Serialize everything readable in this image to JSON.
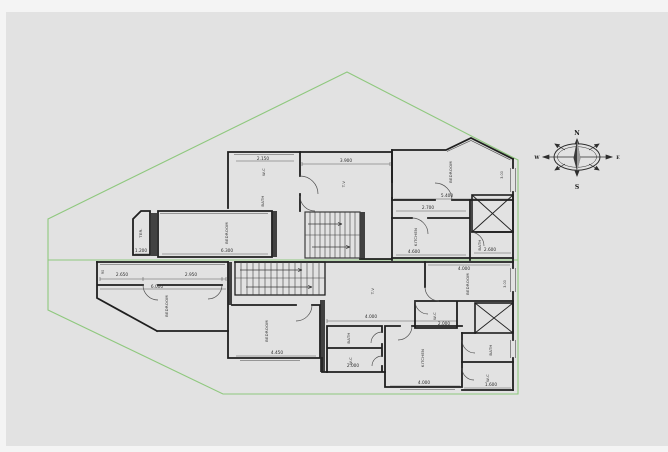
{
  "page": {
    "bg": "#f6f6f6",
    "canvas_bg": "#e2e2e2"
  },
  "colors": {
    "wall": "#1f1f1f",
    "thin": "#4a4a4a",
    "green": "#8fc87e",
    "text": "#2e2e2e"
  },
  "compass": {
    "north": "N",
    "south": "S",
    "east": "E",
    "west": "W"
  },
  "dims": {
    "wc_top": "2.150",
    "hall_top": "3.900",
    "bed1": "5.400",
    "corridor": "2.700",
    "kitchen1": "4.600",
    "bath1": "2.600",
    "balcony": "1.200",
    "bed2": "6.300",
    "lobby_a": "2.650",
    "lobby_b": "2.950",
    "lobby_total": "6.000",
    "bed3": "4.450",
    "bath_mid": "2.000",
    "hall2": "4.000",
    "wc_low": "2.000",
    "bed4": "4.000",
    "kitchen2": "4.000",
    "bath_right": "1.600",
    "door_a": "90",
    "win_a": "3.00",
    "win_b": "3.00"
  },
  "rooms": {
    "wc1": "W.C",
    "bath_top": "BATH",
    "hall1": "T.V",
    "bed1": "BEDROOM",
    "kitchen1": "KITCHEN",
    "bath1": "BATH",
    "balcony": "TER.",
    "bed2": "BEDROOM",
    "bed3": "BEDROOM",
    "bed_low": "BEDROOM",
    "bath_a": "BATH",
    "bath_b": "W.C",
    "hall2": "T.V",
    "bed4": "BEDROOM",
    "kitchen2": "KITCHEN",
    "bath_c": "BATH",
    "wc_d": "W.C"
  }
}
